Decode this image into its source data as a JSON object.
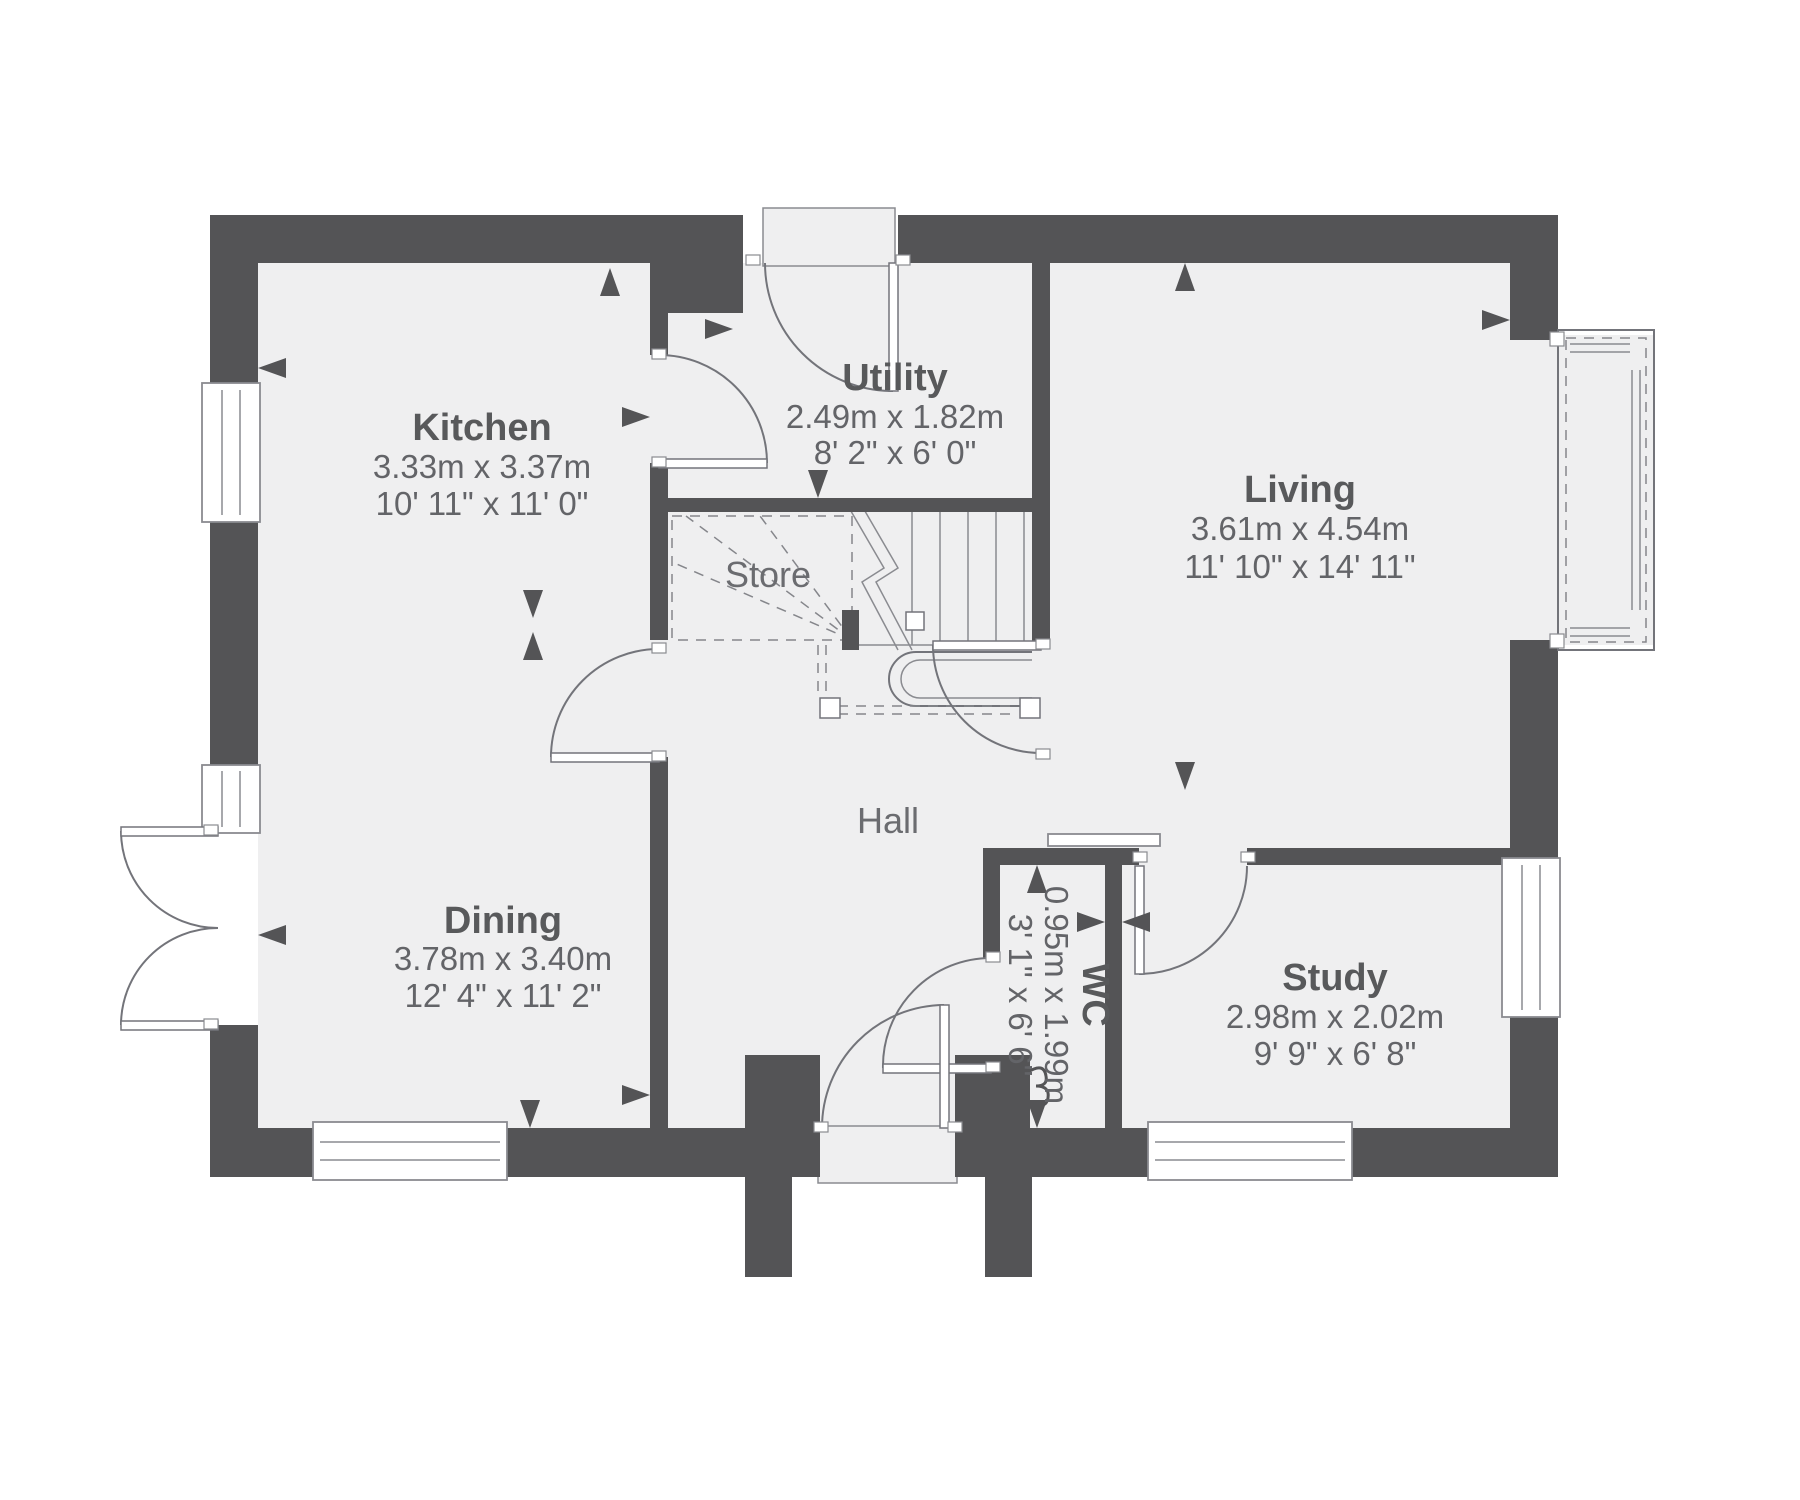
{
  "rooms": {
    "kitchen": {
      "name": "Kitchen",
      "metric": "3.33m x 3.37m",
      "imperial": "10' 11\" x 11' 0\""
    },
    "utility": {
      "name": "Utility",
      "metric": "2.49m x 1.82m",
      "imperial": "8' 2\" x 6' 0\""
    },
    "living": {
      "name": "Living",
      "metric": "3.61m x 4.54m",
      "imperial": "11' 10\" x 14' 11\""
    },
    "dining": {
      "name": "Dining",
      "metric": "3.78m x 3.40m",
      "imperial": "12' 4\" x 11' 2\""
    },
    "wc": {
      "name": "WC",
      "metric": "0.95m x 1.99m",
      "imperial": "3' 1\" x 6' 6\""
    },
    "study": {
      "name": "Study",
      "metric": "2.98m x 2.02m",
      "imperial": "9' 9\" x 6' 8\""
    }
  },
  "areas": {
    "store": "Store",
    "hall": "Hall"
  },
  "colors": {
    "wall": "#545456",
    "floor": "#efeff0",
    "line": "#73747a",
    "label_text": "#58595b",
    "dimension_text": "#636468",
    "background": "#ffffff"
  }
}
